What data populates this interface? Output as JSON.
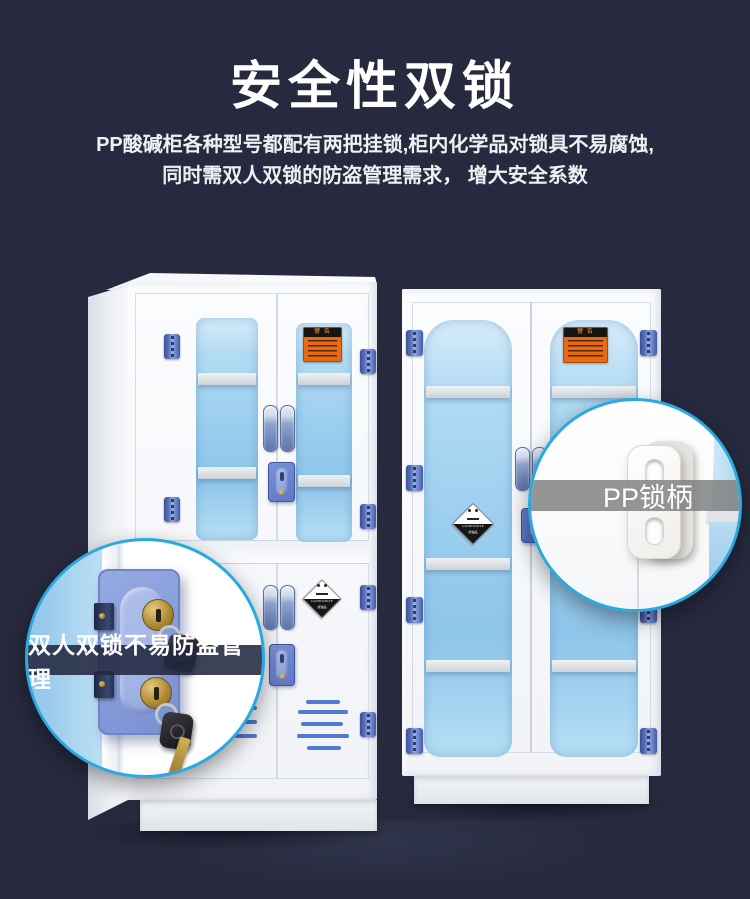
{
  "page": {
    "background": "#272a3e",
    "accent": "#2aa9e0"
  },
  "header": {
    "title": "安全性双锁",
    "description_line1": "PP酸碱柜各种型号都配有两把挂锁,柜内化学品对锁具不易腐蚀,",
    "description_line2": "同时需双人双锁的防盗管理需求， 增大安全系数"
  },
  "callouts": {
    "double_lock": {
      "label": "双人双锁不易防盗管理"
    },
    "pp_handle": {
      "label": "PP锁柄"
    }
  },
  "hazard_labels": {
    "warning_banner": "警 告",
    "corrosive_title": "CORROSIVE",
    "corrosive_sub": "腐蚀品"
  },
  "colors": {
    "window_blue": "#9ccfef",
    "hinge_blue": "#6a85cc",
    "vent_blue": "#4f7cd2",
    "lock_plate_blue": "#7b90d2",
    "warning_orange": "#ea6a12",
    "callout_border": "#2aa9e0"
  }
}
